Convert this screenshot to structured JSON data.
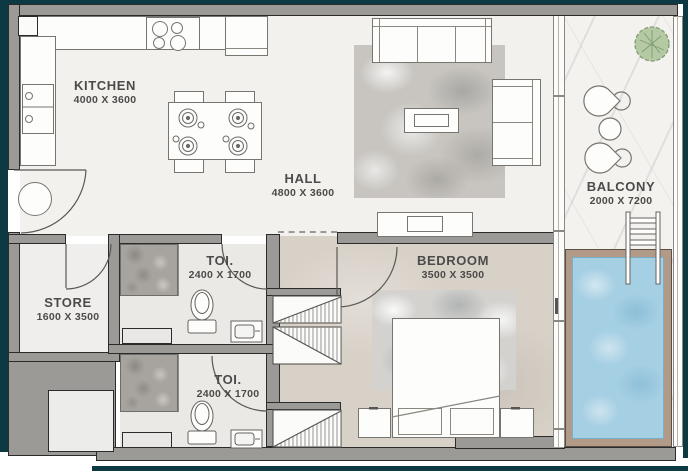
{
  "plan": {
    "type": "apartment-floor-plan",
    "rooms": [
      {
        "name": "KITCHEN",
        "dims": "4000 X 3600"
      },
      {
        "name": "HALL",
        "dims": "4800 X 3600"
      },
      {
        "name": "BALCONY",
        "dims": "2000 X 7200"
      },
      {
        "name": "STORE",
        "dims": "1600 X 3500"
      },
      {
        "name": "TOI.",
        "dims": "2400 X 1700"
      },
      {
        "name": "TOI.",
        "dims": "2400 X 1700"
      },
      {
        "name": "BEDROOM",
        "dims": "3500 X 3500"
      }
    ],
    "colors": {
      "frame": "#0d3a42",
      "wall": "#9c9a97",
      "wall_outline": "#2b2b2b",
      "floor": "#f2f1ee",
      "bedroom_floor": "#d8d1c8",
      "shower_tile": "#a7a49f",
      "marble": "#f4f2ef",
      "pool_water": "#a5cfe3",
      "pool_deck": "#b29a88",
      "tree": "#b4c9a4",
      "label_text": "#4c4b49"
    }
  }
}
